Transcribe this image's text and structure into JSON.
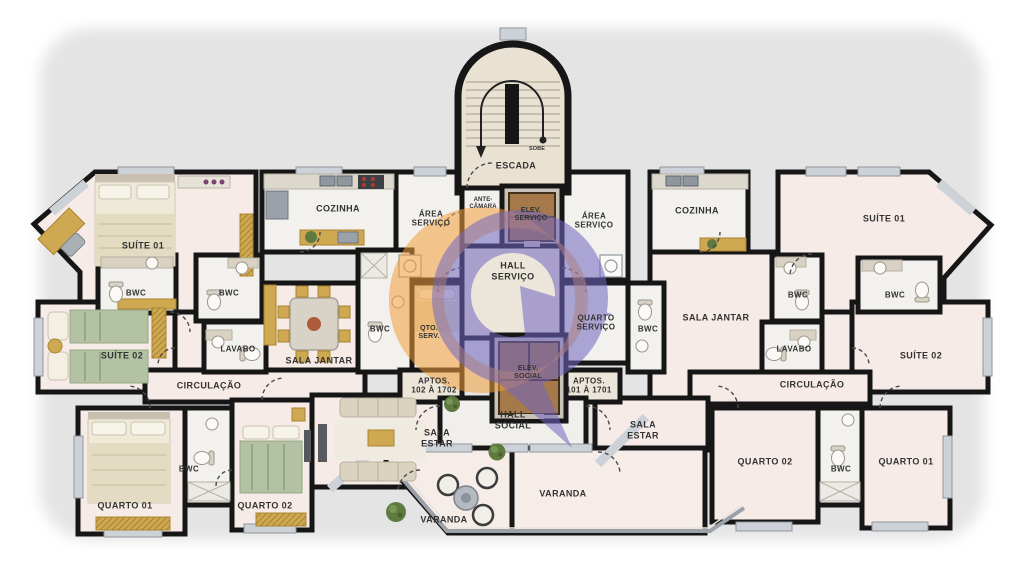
{
  "meta": {
    "type": "residential floor plan",
    "language": "pt-BR"
  },
  "colors": {
    "wall": "#161616",
    "floor_pink": "#f7ebe8",
    "floor_tile": "#f2f1ee",
    "floor_hall": "#ece6da",
    "floor_stair": "#e9e2d2",
    "window": "#ccd2d8",
    "logo_orange": "#f29e3c",
    "logo_purple": "#7166c2",
    "furniture_wood": "#cfa852",
    "bed_green": "#b3c2a2",
    "bed_cream": "#e9e3cd"
  },
  "core": {
    "escada": "ESCADA",
    "sobe": "SOBE",
    "ante_camara": "ANTE-\nCÂMARA",
    "elev_servico": "ELEV.\nSERVIÇO",
    "hall_servico": "HALL\nSERVIÇO",
    "elev_social": "ELEV.\nSOCIAL",
    "hall_social": "HALL\nSOCIAL",
    "area_servico_left": "ÁREA\nSERVIÇO",
    "area_servico_right": "ÁREA\nSERVIÇO",
    "quarto_servico": "QUARTO\nSERVIÇO",
    "qto_serv": "QTO.\nSERV.",
    "bwc_servico_left": "BWC",
    "bwc_servico_right": "BWC",
    "aptos_left": "APTOS.\n102 À 1702",
    "aptos_right": "APTOS.\n101 À 1701"
  },
  "left_apartment": {
    "suite01": "SUÍTE 01",
    "cozinha": "COZINHA",
    "bwc_suite": "BWC",
    "bwc_social": "BWC",
    "lavabo": "LAVABO",
    "suite02": "SUÍTE 02",
    "sala_jantar": "SALA JANTAR",
    "circulacao": "CIRCULAÇÃO",
    "quarto01": "QUARTO 01",
    "bwc_quartos": "BWC",
    "quarto02": "QUARTO 02",
    "sala_estar": "SALA\nESTAR",
    "varanda": "VARANDA"
  },
  "right_apartment": {
    "suite01": "SUÍTE 01",
    "cozinha": "COZINHA",
    "bwc_suite": "BWC",
    "bwc_social": "BWC",
    "lavabo": "LAVABO",
    "suite02": "SUÍTE 02",
    "sala_jantar": "SALA JANTAR",
    "circulacao": "CIRCULAÇÃO",
    "quarto01": "QUARTO 01",
    "bwc_quartos": "BWC",
    "quarto02": "QUARTO 02",
    "sala_estar": "SALA\nESTAR",
    "varanda": "VARANDA"
  }
}
